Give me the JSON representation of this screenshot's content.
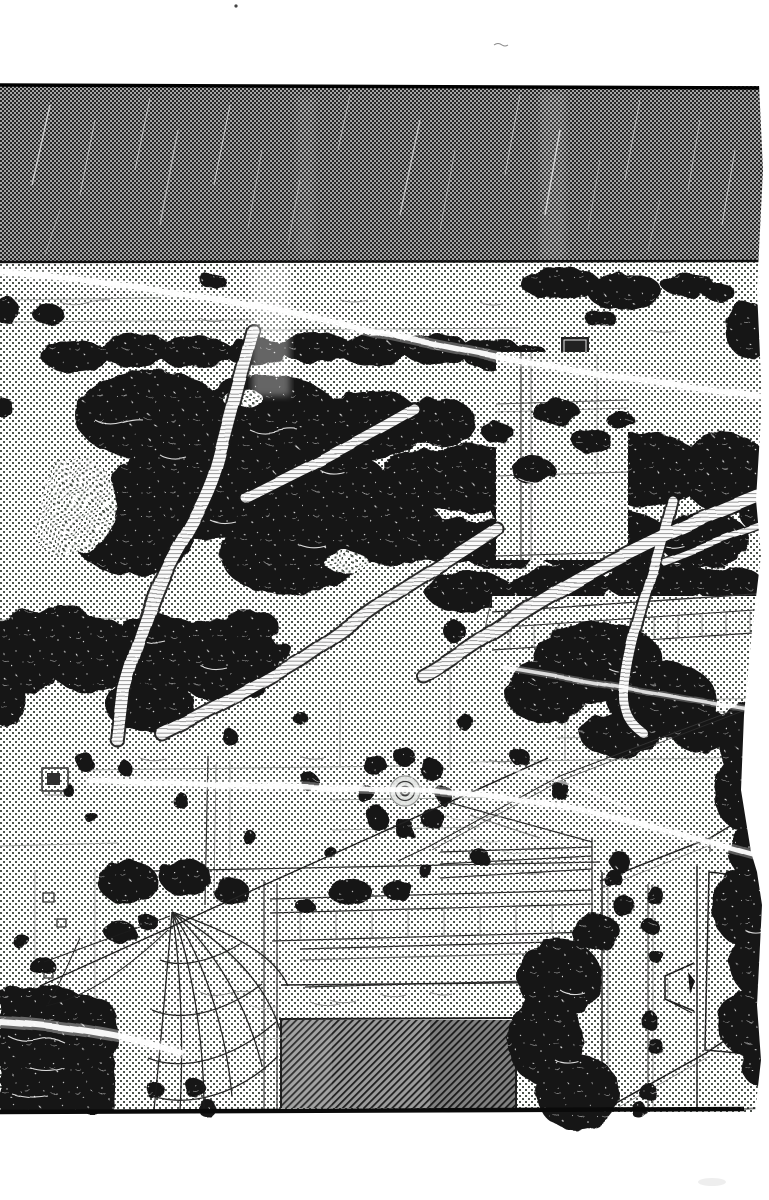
{
  "meta": {
    "width": 769,
    "height": 1200,
    "kind": "monochrome-manga-panel"
  },
  "palette": {
    "paper": "#ffffff",
    "ink": "#161616",
    "line": "#3c3c3c",
    "wall_dot": "#4c524c",
    "roof_base": "#a6a6a6",
    "roof_dark": "#262626",
    "door_base": "#9b9b9b",
    "door_line": "#1f1f1f",
    "vine_paper": "#fbfbfb",
    "vine_hatch": "#8c8c8c",
    "highlight": "#ffffff"
  },
  "scene": {
    "panel": "ivy-covered building wall under dark shingle roof, entrance with hatched door, hanging torn net, light scratches and cables",
    "elements": [
      "roof-band",
      "brick-wall",
      "ivy-foliage",
      "vine-branches",
      "light-streaks",
      "round-vent",
      "window",
      "door-opening",
      "door-lintel",
      "stone-beams",
      "hanging-net",
      "wall-pillar",
      "corner-shadow-mass",
      "torn-page-edge"
    ]
  }
}
